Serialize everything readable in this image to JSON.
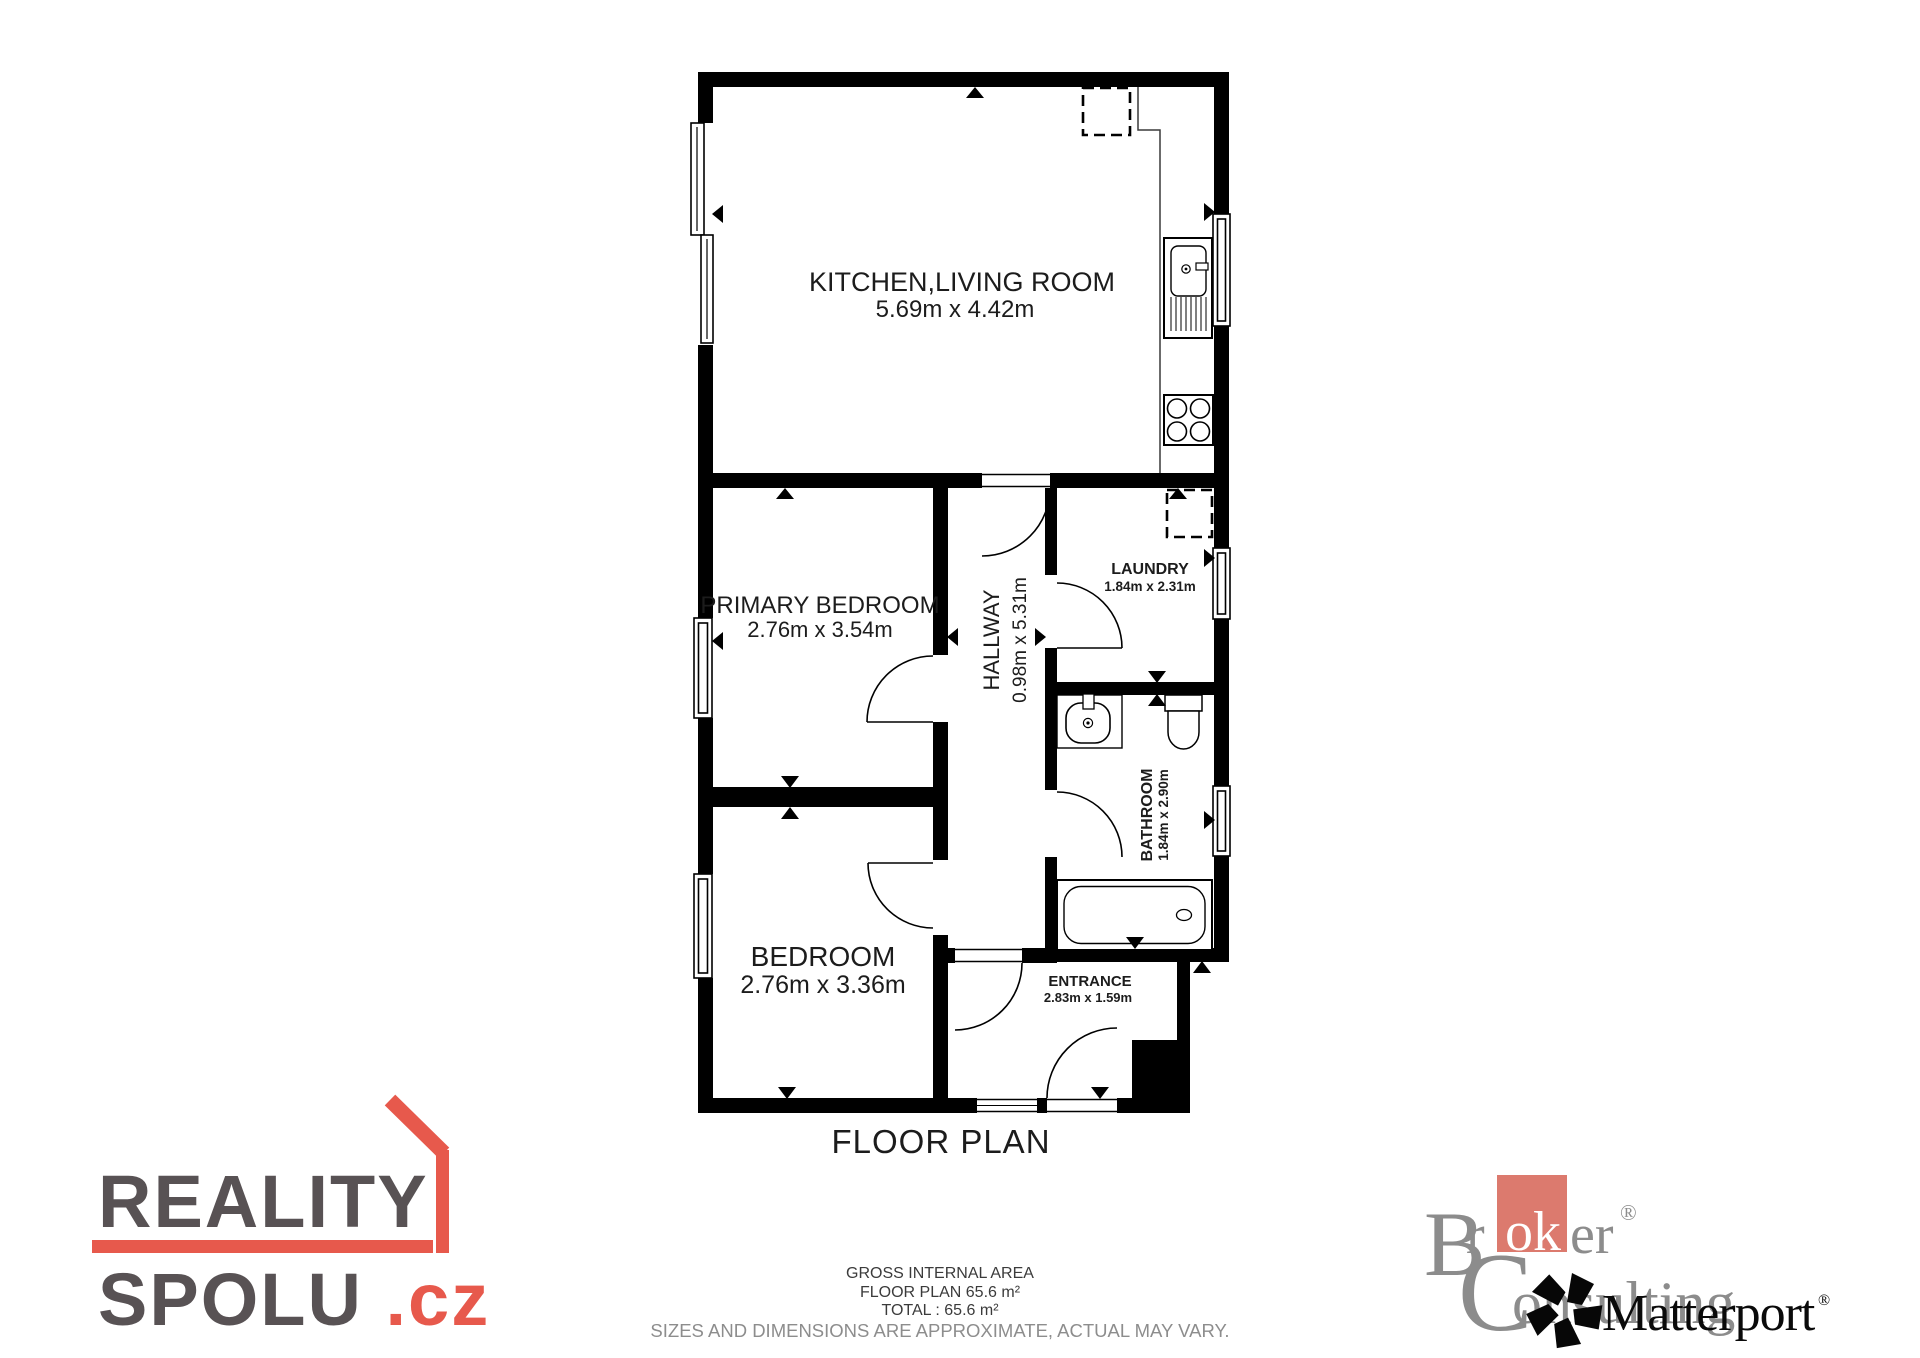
{
  "floor_plan": {
    "title": "FLOOR PLAN",
    "rooms": {
      "kitchen_living_room": {
        "name": "KITCHEN,LIVING ROOM",
        "dimensions": "5.69m x 4.42m"
      },
      "primary_bedroom": {
        "name": "PRIMARY BEDROOM",
        "dimensions": "2.76m x 3.54m"
      },
      "bedroom": {
        "name": "BEDROOM",
        "dimensions": "2.76m x 3.36m"
      },
      "hallway": {
        "name": "HALLWAY",
        "dimensions": "0.98m x 5.31m"
      },
      "laundry": {
        "name": "LAUNDRY",
        "dimensions": "1.84m x 2.31m"
      },
      "bathroom": {
        "name": "BATHROOM",
        "dimensions": "1.84m x 2.90m"
      },
      "entrance": {
        "name": "ENTRANCE",
        "dimensions": "2.83m x 1.59m"
      }
    }
  },
  "footer": {
    "gross_internal_area": "GROSS INTERNAL AREA",
    "floor_plan_area": "FLOOR PLAN 65.6 m²",
    "total_area": "TOTAL :  65.6 m²",
    "disclaimer": "SIZES AND DIMENSIONS ARE APPROXIMATE, ACTUAL MAY VARY."
  },
  "branding": {
    "reality_spolu": {
      "word1": "REALITY",
      "word2": "SPOLU",
      "tld": ".cz",
      "accent_color": "#e7594c",
      "text_color": "#585254"
    },
    "broker_consulting": {
      "b_initial": "B",
      "r_fragment": "r",
      "ok_fragment": "ok",
      "er_fragment": "er",
      "c_initial": "C",
      "onsulting_fragment": "onsulting",
      "registered": "®",
      "square_color": "#dc7a6e",
      "text_color": "#8c8c8c"
    },
    "matterport": {
      "name": "Matterport",
      "registered": "®",
      "color": "#0a0a0a"
    }
  }
}
